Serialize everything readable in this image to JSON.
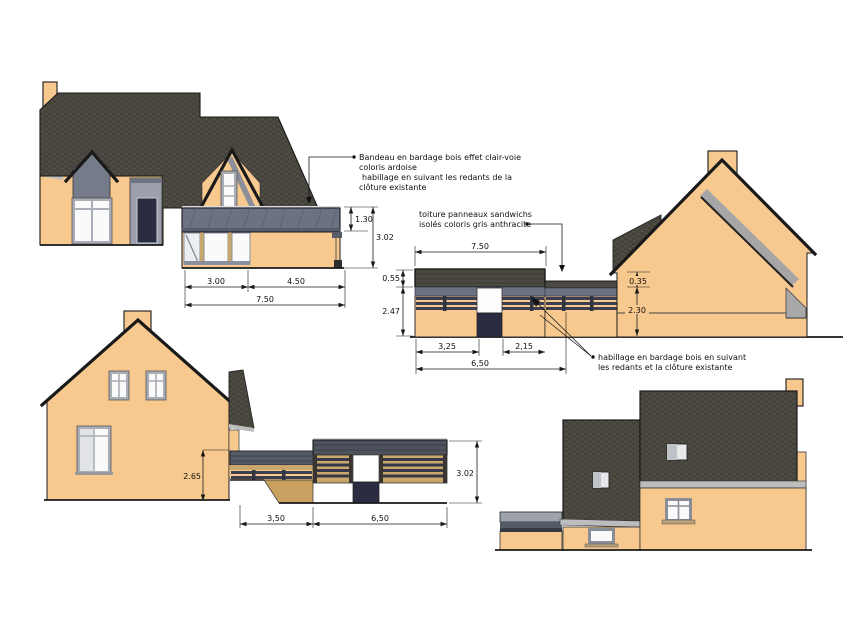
{
  "annotations": {
    "bandeau": {
      "line1": "Bandeau en bardage bois effet clair-voie",
      "line2": "coloris ardoise",
      "line3": "habillage en suivant les redants de la",
      "line4": "clôture existante"
    },
    "toiture": {
      "line1": "toiture panneaux sandwichs",
      "line2": "isolés coloris gris anthracite"
    },
    "habillage": {
      "line1": "habillage en bardage bois en suivant",
      "line2": "les redants et la clôture existante"
    }
  },
  "dimensions": {
    "front": {
      "band_height": "1.30",
      "total_height": "3.02",
      "left_width": "3.00",
      "right_width": "4.50",
      "total_width": "7.50"
    },
    "courtyard": {
      "top_width": "7.50",
      "roof_thickness": "0.55",
      "fence_height": "2.47",
      "left_width": "3,25",
      "right_width": "2,15",
      "total_width": "6,50",
      "gable_band": "0.35",
      "gable_wall": "2.30"
    },
    "side": {
      "height": "2.65",
      "left_width": "3,50",
      "right_width": "6,50",
      "total_height": "3.02"
    }
  },
  "colors": {
    "wall": "#F8C98F",
    "roof": "#45433B",
    "slate": "#6D7282",
    "navy": "#2A2D42",
    "wood": "#C9A76A",
    "glass": "#FAFAFB",
    "frame": "#A9ADB5",
    "gutter": "#BDBDBD",
    "line": "#1A1A1A"
  }
}
